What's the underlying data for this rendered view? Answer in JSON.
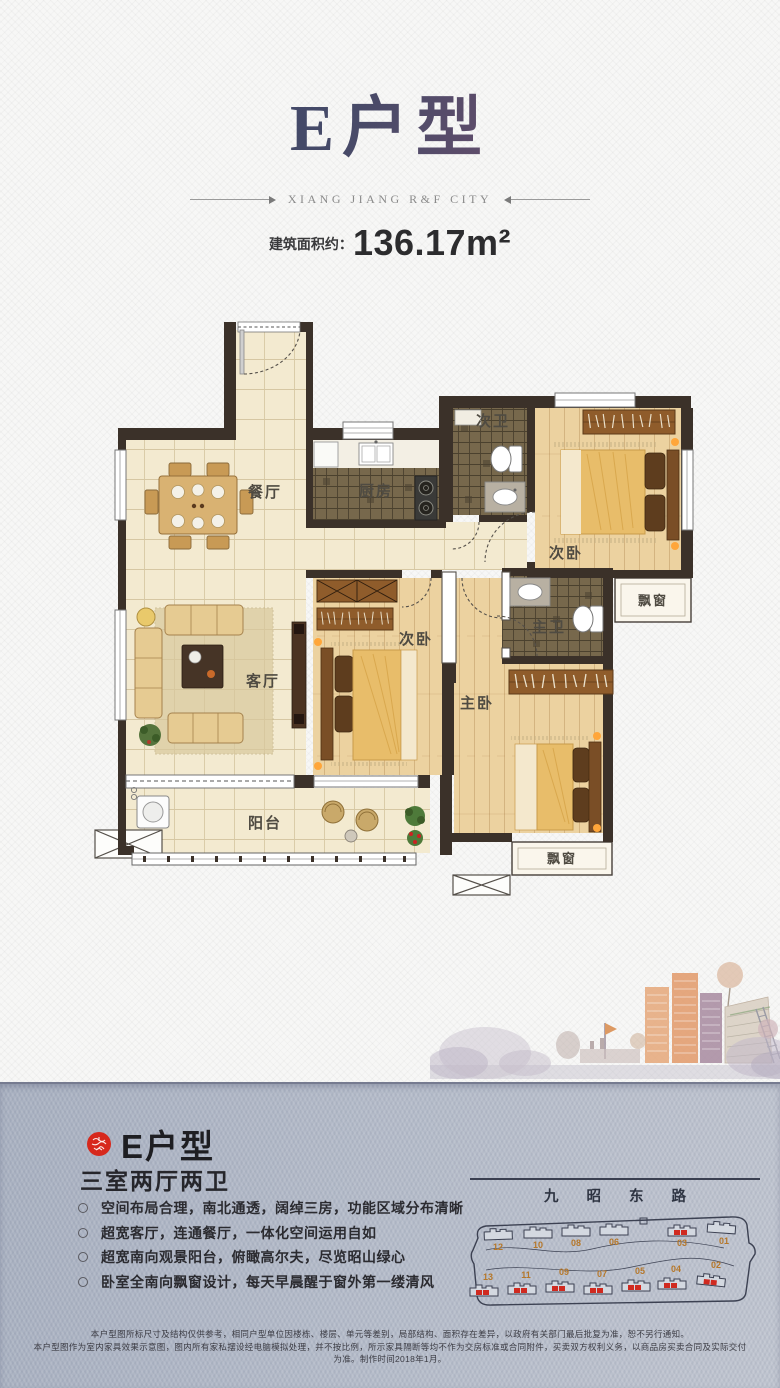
{
  "header": {
    "title": "E户型",
    "tagline": "XIANG JIANG R&F CITY",
    "area_label": "建筑面积约：",
    "area_value": "136.17m²"
  },
  "floorplan": {
    "labels": {
      "dining": "餐厅",
      "kitchen": "厨房",
      "bath2": "次卫",
      "bedroom2_north": "次卧",
      "bay_east": "飘窗",
      "bath_master": "主卫",
      "living": "客厅",
      "bedroom2_west": "次卧",
      "bedroom_master": "主卧",
      "balcony": "阳台",
      "bay_south": "飘窗"
    }
  },
  "details": {
    "seal_color": "#d7281c",
    "unit_title": "E户型",
    "unit_subtitle": "三室两厅两卫",
    "features": [
      "空间布局合理，南北通透，阔绰三房，功能区域分布清晰",
      "超宽客厅，连通餐厅，一体化空间运用自如",
      "超宽南向观景阳台，俯瞰高尔夫，尽览昭山绿心",
      "卧室全南向飘窗设计，每天早晨醒于窗外第一缕清风"
    ]
  },
  "sitemap": {
    "road_name": "九昭东路",
    "buildings_top": [
      "12",
      "10",
      "08",
      "06",
      "03",
      "01"
    ],
    "buildings_bottom": [
      "13",
      "11",
      "09",
      "07",
      "05",
      "04",
      "02"
    ],
    "highlighted_buildings": [
      "03",
      "13",
      "11",
      "09",
      "07",
      "05",
      "04",
      "02"
    ],
    "highlight_color": "#d02a20"
  },
  "disclaimer": {
    "line1": "本户型图所标尺寸及结构仅供参考，相同户型单位因楼栋、楼层、单元等差别，局部结构、面积存在差异，以政府有关部门最后批复为准，恕不另行通知。",
    "line2": "本户型图作为室内家具效果示意图，图内所有家私摆设经电脑模拟处理，并不按比例，所示家具隔断等均不作为交房标准或合同附件，买卖双方权利义务，以商品房买卖合同及实际交付为准。制作时间2018年1月。"
  }
}
